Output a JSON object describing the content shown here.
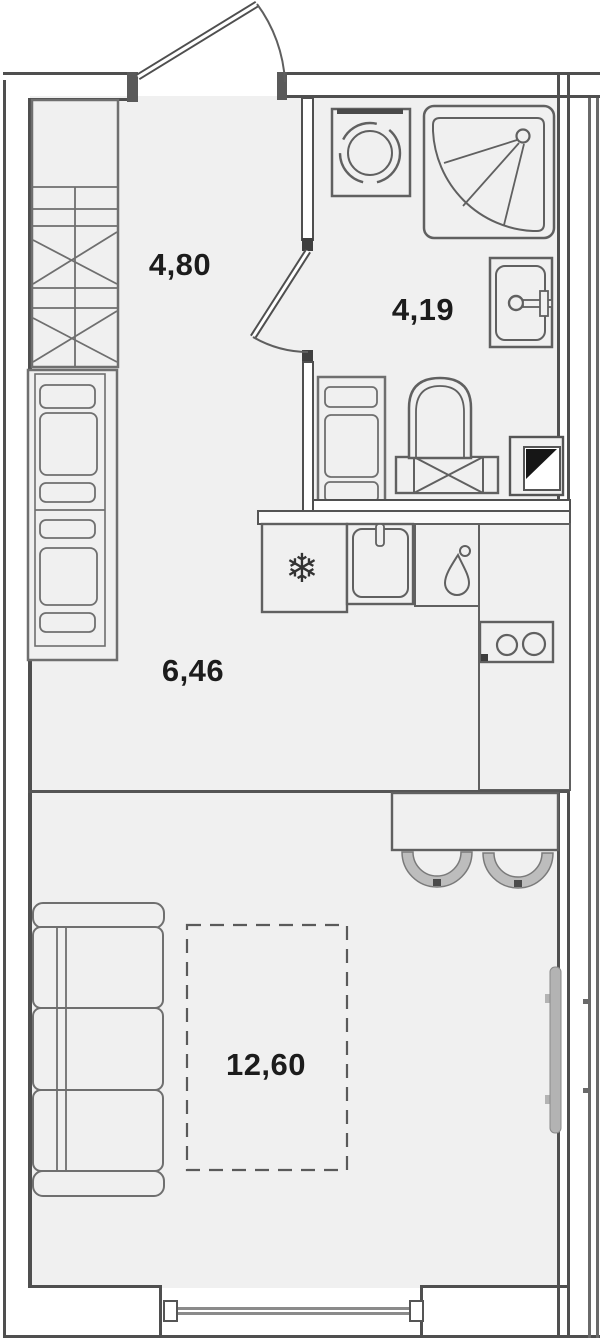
{
  "plan": {
    "type": "apartment-floor-plan",
    "unit": "studio",
    "rooms": [
      {
        "id": "hallway",
        "area_label": "4,80"
      },
      {
        "id": "bathroom",
        "area_label": "4,19"
      },
      {
        "id": "kitchen",
        "area_label": "6,46"
      },
      {
        "id": "living-room",
        "area_label": "12,60"
      }
    ],
    "icons": {
      "fridge_snowflake": "❄"
    },
    "colors": {
      "wall": "#4f4f4f",
      "furniture_line": "#6f6f6f",
      "floor": "#f0f0f0",
      "radiator_fill": "#b3b3b3",
      "stool_fill": "#bdbdbd",
      "vent_triangle": "#161616",
      "label_text": "#1c1c1c"
    }
  }
}
